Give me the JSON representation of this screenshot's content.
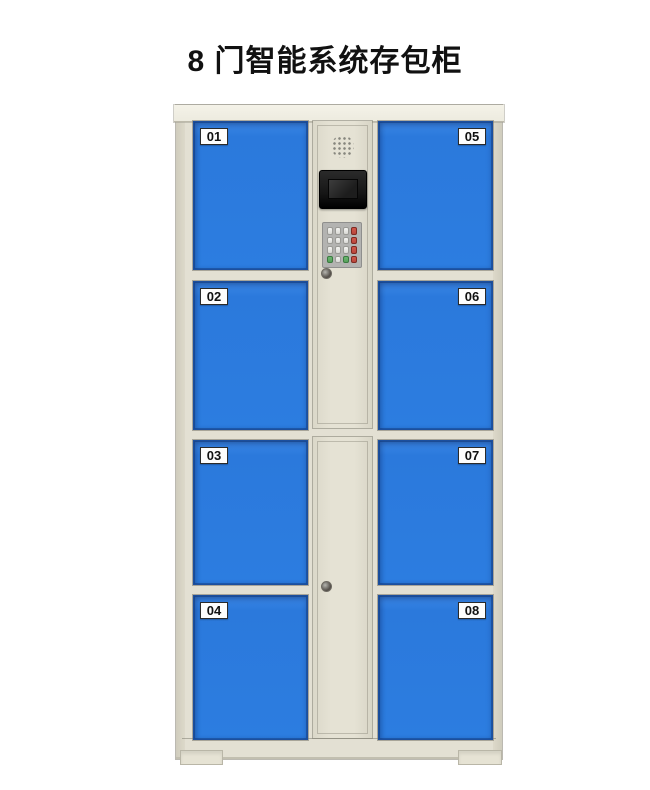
{
  "title": "8 门智能系统存包柜",
  "cabinet": {
    "doors": [
      {
        "label": "01",
        "side": "left",
        "row": 1
      },
      {
        "label": "02",
        "side": "left",
        "row": 2
      },
      {
        "label": "03",
        "side": "left",
        "row": 3
      },
      {
        "label": "04",
        "side": "left",
        "row": 4
      },
      {
        "label": "05",
        "side": "right",
        "row": 1
      },
      {
        "label": "06",
        "side": "right",
        "row": 2
      },
      {
        "label": "07",
        "side": "right",
        "row": 3
      },
      {
        "label": "08",
        "side": "right",
        "row": 4
      }
    ],
    "control_panel": {
      "components": [
        "speaker-grille",
        "display-screen",
        "keypad",
        "keyhole"
      ],
      "keypad_rows": [
        [
          "light",
          "light",
          "light",
          "red"
        ],
        [
          "light",
          "light",
          "light",
          "red"
        ],
        [
          "light",
          "light",
          "light",
          "red"
        ],
        [
          "green",
          "light",
          "green",
          "red"
        ]
      ]
    }
  },
  "colors": {
    "background": "#ffffff",
    "title_text": "#111111",
    "door_blue": "#2c7de0",
    "door_blue_dark": "#1c4f9e",
    "frame_beige": "#e3e0d3",
    "frame_beige_light": "#edebdf",
    "frame_beige_dark": "#cfccbd",
    "label_bg": "#fdfdfd",
    "key_light": "#e9e9e7",
    "key_red": "#b8463c",
    "key_green": "#57a05a",
    "screen_black": "#161616"
  }
}
